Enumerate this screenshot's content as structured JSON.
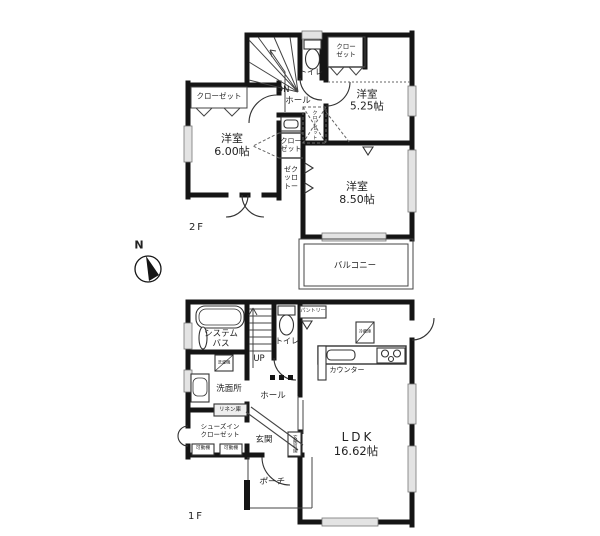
{
  "compass": {
    "north_label": "N"
  },
  "floor2": {
    "floor_label": "2F",
    "labels": {
      "closet_left": "クローゼット",
      "room_600": "洋室\n6.00帖",
      "closet_mid": "クロー\nゼット",
      "closet_tall": "ゼク\nッロ\nトー",
      "closet_attic": "クローゼット",
      "stairs_dn": "DN",
      "hall": "ホール",
      "toilet": "トイレ",
      "closet_right": "クロー\nゼット",
      "room_525": "洋室\n5.25帖",
      "room_850": "洋室\n8.50帖",
      "balcony": "バルコニー"
    }
  },
  "floor1": {
    "floor_label": "1F",
    "labels": {
      "system_bath": "システム\nバス",
      "stairs_up": "UP",
      "toilet": "トイレ",
      "pantry": "パントリー",
      "refrigerator": "冷蔵庫",
      "counter": "カウンター",
      "washroom": "洗面所",
      "washing_machine": "洗濯機",
      "hall": "ホール",
      "linen": "リネン庫",
      "shoe_closet": "シューズイン\nクローゼット",
      "shelf_left": "可動棚",
      "shelf_right": "可動棚",
      "entrance": "玄関",
      "entrance_storage": "玄関収納",
      "porch": "ポーチ",
      "ldk_name": "LDK",
      "ldk_size": "16.62帖"
    }
  },
  "colors": {
    "wall": "#151515",
    "window_fill": "#e3e3e3",
    "text": "#222222",
    "background": "#ffffff"
  }
}
